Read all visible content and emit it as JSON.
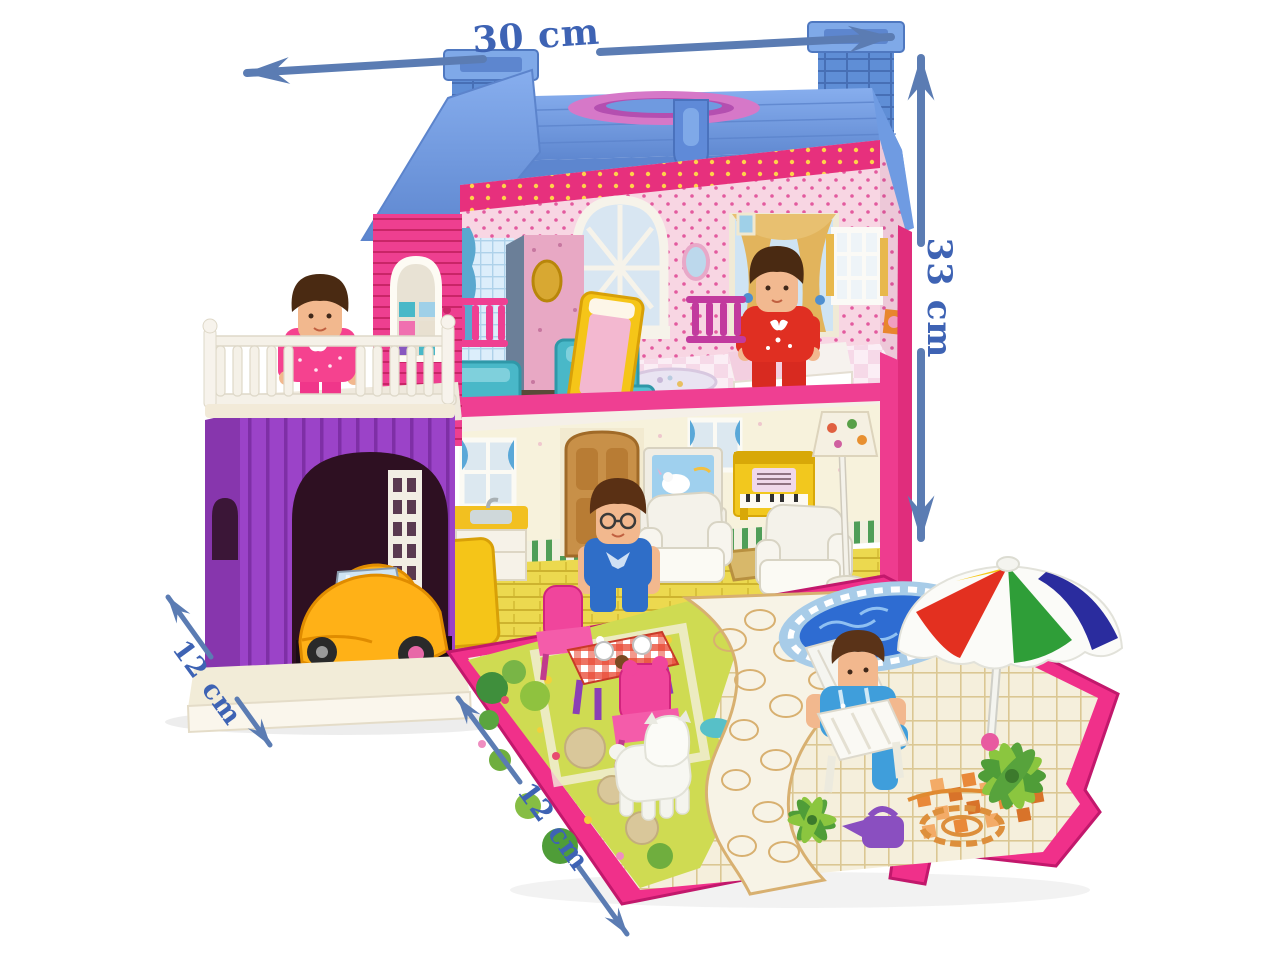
{
  "image_type": "product-photo",
  "subject": "Folding toy dollhouse playset with roof handle, garage, four mini figures, car, furniture and fold-out garden play mat",
  "annotations": {
    "width": {
      "label": "30 cm",
      "position": "top",
      "orientation": "horizontal"
    },
    "height": {
      "label": "33 cm",
      "position": "right",
      "orientation": "vertical"
    },
    "base_depth": {
      "label": "12 cm",
      "position": "left",
      "orientation": "diagonal"
    },
    "mat_width": {
      "label": "12 cm",
      "position": "bottom",
      "orientation": "diagonal"
    }
  },
  "palette": {
    "background": "#ffffff",
    "arrow_blue": "#5b7cb3",
    "label_blue": "#3e63b4",
    "roof_blue": "#6f9be2",
    "wall_hot_pink": "#ee3c8f",
    "wallpaper_pink": "#f8d6e3",
    "garage_purple": "#9b43c8",
    "balcony_white": "#f5f1e8",
    "car_yellow": "#ffb117",
    "bath_teal": "#49b8c8",
    "mat_green": "#cfdb52",
    "mat_cream": "#f5efdc",
    "pool_blue": "#2e6cd2",
    "umbrella_red": "#e33020",
    "umbrella_green": "#2f9e38",
    "umbrella_yellow": "#f5c818",
    "umbrella_navy": "#2a2c9e",
    "table_red": "#e23b2c",
    "chair_pink": "#f0459c",
    "figure_skin": "#f2b88e"
  }
}
